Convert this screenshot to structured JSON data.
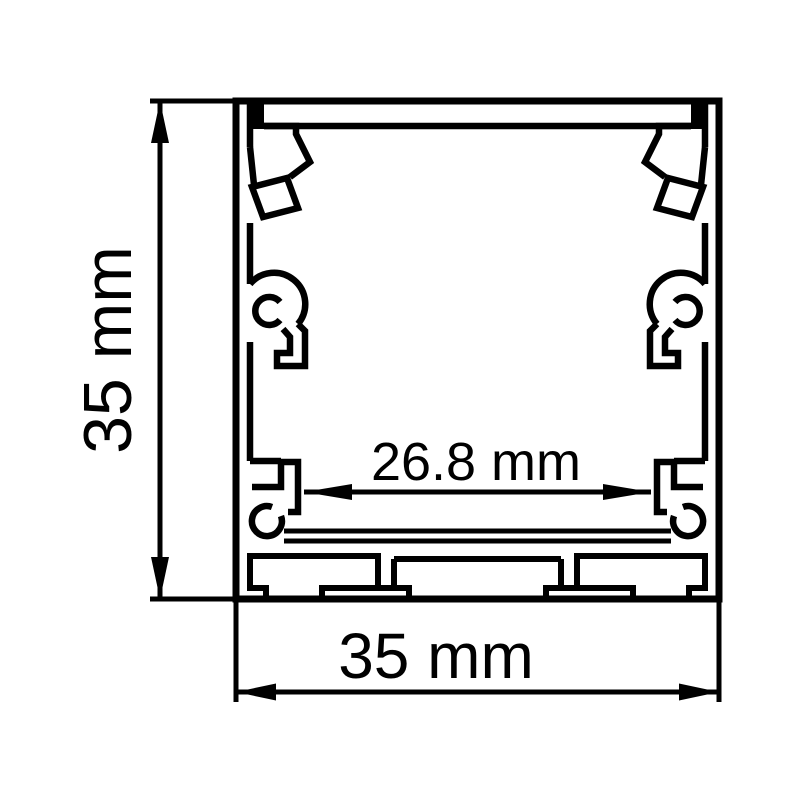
{
  "diagram": {
    "type": "technical-cross-section-drawing",
    "subject": "aluminum LED profile channel cross-section",
    "background_color": "#ffffff",
    "line_color": "#000000",
    "dimensions": {
      "height": {
        "label": "35 mm",
        "orientation": "vertical",
        "side": "left"
      },
      "width": {
        "label": "35 mm",
        "orientation": "horizontal",
        "side": "bottom"
      },
      "inner_width": {
        "label": "26.8 mm",
        "orientation": "horizontal",
        "side": "inside"
      }
    }
  }
}
